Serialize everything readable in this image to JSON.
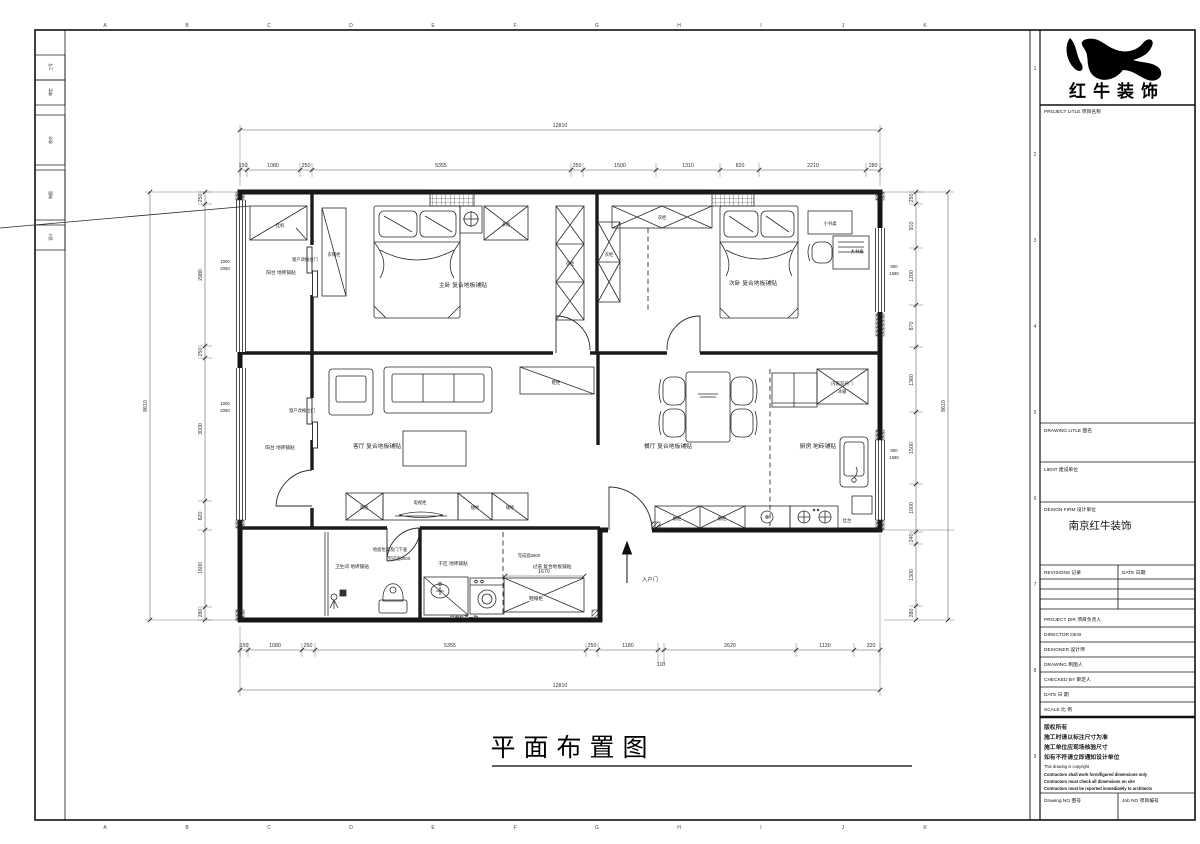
{
  "sheet": {
    "drawing_title": "平面布置图",
    "grid_letters": [
      "A",
      "B",
      "C",
      "D",
      "E",
      "F",
      "G",
      "H",
      "I",
      "J",
      "K"
    ],
    "grid_numbers": [
      "1",
      "2",
      "3",
      "4",
      "5",
      "6",
      "7",
      "8",
      "9"
    ],
    "margin_cells": [
      "工号",
      "审定",
      "校对",
      "制图",
      "设计"
    ]
  },
  "title_block": {
    "logo_text": "红牛装饰",
    "project_title_label": "PROJECT LITLE  项目名称",
    "drawing_title_label": "DRAWING LITLE  图名",
    "client_label": "LIENT  建设单位",
    "design_firm_label": "DESIGN FIRM  设计单位",
    "design_firm_value": "南京红牛装饰",
    "revisions_label": "REVISIONS  记录",
    "date_col_label": "DATE  日期",
    "project_dir_label": "PROJECT DIR    项目负责人",
    "director_label": "DIRECTOR DESI",
    "designer_label": "DESIGNER       设计师",
    "drawing_label": "DRAWING        制图人",
    "checked_label": "CHECKED BY   审定人",
    "date_label": "DATE           日  期",
    "scale_label": "SCALE          比  例",
    "copyright_cn": [
      "版权所有",
      "施工时请以标注尺寸为准",
      "施工单位应现场核验尺寸",
      "如有不符请立即通知设计单位"
    ],
    "copyright_en": [
      "This drawing is copyright",
      "Contractors shall work form/figured dimensions only",
      "Contractors must check all dimensions on site",
      "Contractors must be reported immediately to architects"
    ],
    "drawing_no_label": "Drawing NO  图号",
    "job_no_label": "Job NO  项目编号"
  },
  "plan": {
    "rooms": {
      "master": "主卧 复合地板铺贴",
      "second": "次卧 复合地板铺贴",
      "living": "客厅 复合地板铺贴",
      "dining": "餐厅 复合地板铺贴",
      "kitchen": "厨房 地砖铺贴",
      "bath": "卫生间 地砖铺贴",
      "dry": "干区 地砖铺贴",
      "hall": "过道 复合地板铺贴",
      "balcony1": "阳台 地砖铺贴",
      "balcony2": "阳台 地砖铺贴"
    },
    "furn": {
      "ac": "挂机",
      "cloak": "衣帽柜",
      "wardrobe1": "衣柜",
      "wardrobe2": "衣柜",
      "wardrobe3": "衣柜",
      "wardrobe4": "衣柜",
      "small_desk": "小书桌",
      "big_desk": "大书桌",
      "shoe": "鞋柜",
      "tall": "高柜",
      "tv": "电视柜",
      "low1": "矮柜",
      "low2": "矮柜",
      "fridge1": "内嵌双开门",
      "fridge2": "冰箱",
      "counter1": "橱柜",
      "counter2": "橱柜",
      "stove": "灶台",
      "shoehat": "鞋帽柜"
    },
    "notes": {
      "slide1": "窗户改推拉门",
      "slide2": "窗户改推拉门",
      "raise": "地面抬高及门下垂",
      "ffl2600": "完成面2600",
      "ffl2900": "完成面2900",
      "counter_align": "台面标高一致",
      "entry": "入户门"
    },
    "dims": {
      "overall_w": "12810",
      "overall_w2": "12810",
      "overall_h_l": "8610",
      "overall_h_r": "8610",
      "top": [
        "150",
        "1080",
        "250",
        "5355",
        "250",
        "1500",
        "1310",
        "820",
        "2210",
        "280"
      ],
      "bottom": [
        "150",
        "1080",
        "250",
        "5355",
        "250",
        "1180",
        "2620",
        "1130",
        "320"
      ],
      "b_sub": "110",
      "left": [
        "250",
        "2980",
        "250",
        "3000",
        "620",
        "1600",
        "280"
      ],
      "right": [
        "250",
        "910",
        "1200",
        "870",
        "1360",
        "1500",
        "1000",
        "240",
        "1300",
        "280"
      ],
      "hall_w": "1670",
      "winl": [
        "1000",
        "2050"
      ],
      "winr": [
        "900",
        "1580"
      ]
    }
  }
}
